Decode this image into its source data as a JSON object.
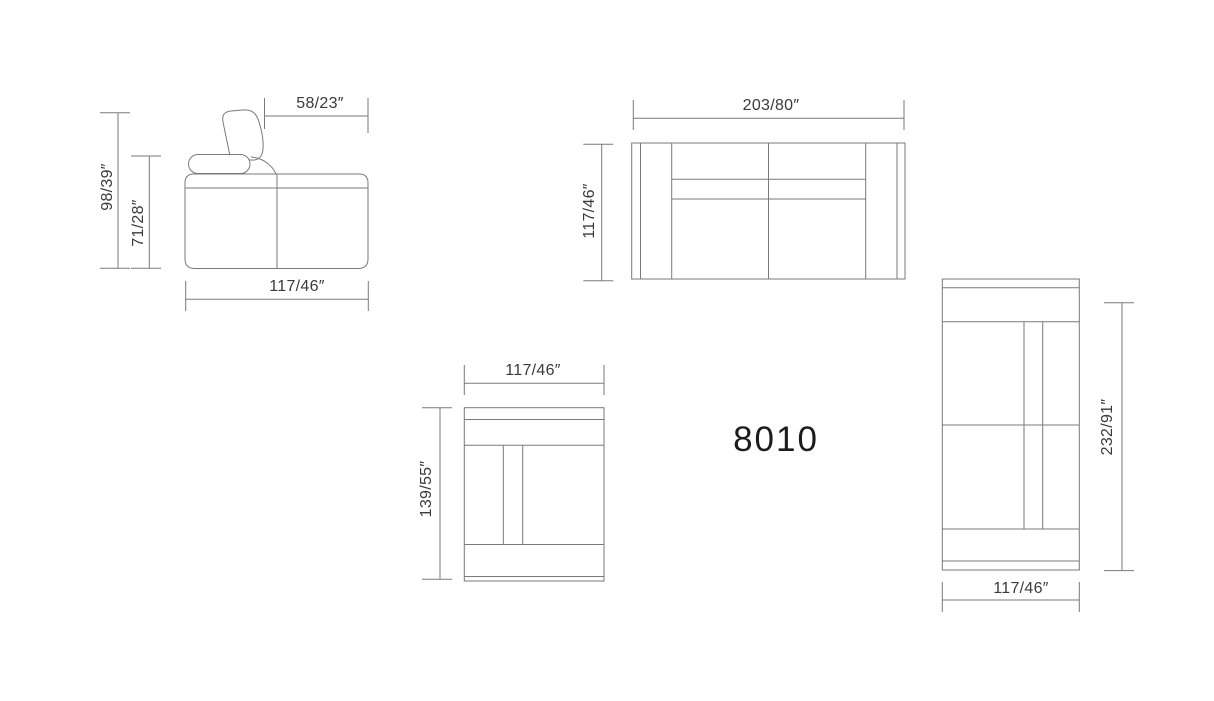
{
  "model_number": "8010",
  "views": {
    "side": {
      "dimensions": {
        "overall_height": "98/39″",
        "arm_height": "71/28″",
        "backrest_top_depth": "58/23″",
        "depth": "117/46″"
      }
    },
    "front": {
      "dimensions": {
        "width": "203/80″",
        "height": "117/46″"
      }
    },
    "chair_top": {
      "dimensions": {
        "width": "117/46″",
        "depth": "139/55″"
      }
    },
    "chaise_top": {
      "dimensions": {
        "length": "232/91″",
        "width": "117/46″"
      }
    }
  },
  "colors": {
    "line": "#7a7a7a",
    "dimension_text": "#3a3a3a",
    "model_text": "#1c1c1c",
    "background": "#ffffff"
  }
}
